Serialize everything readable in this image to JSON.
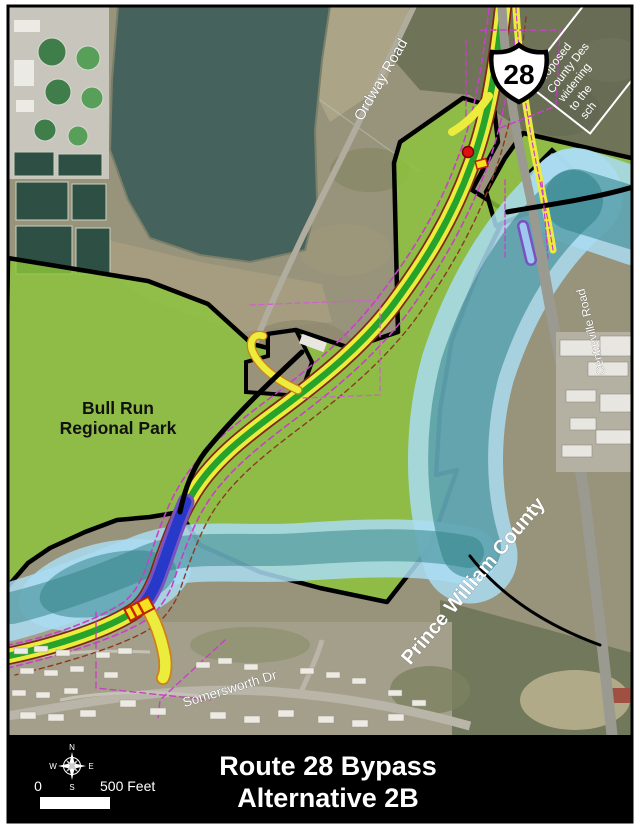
{
  "map": {
    "route_shield_number": "28",
    "park_label": {
      "line1": "Bull Run",
      "line2": "Regional Park"
    },
    "road_labels": {
      "ordway": "Ordway Road",
      "centreville": "Centreville Road",
      "somersworth": "Somersworth Dr"
    },
    "county_label": "Prince William County",
    "note_box": {
      "line1": "Proposed",
      "line2": "County Des",
      "line3": "widening",
      "line4": "to the",
      "line5": "sch"
    }
  },
  "title_bar": {
    "line1": "Route 28 Bypass",
    "line2": "Alternative 2B",
    "scale_zero": "0",
    "scale_label": "500 Feet",
    "compass": {
      "n": "N",
      "s": "S",
      "e": "E",
      "w": "W"
    }
  },
  "palette": {
    "park_green": "#8cc63c",
    "floodplain_blue": "#aadcf2",
    "water_teal": "#2e7f86",
    "bypass_yellow": "#ecec3d",
    "bypass_green": "#27a22b",
    "bypass_edge_red": "#7e2817",
    "bridge_blue": "#2739c8",
    "bridge_purple": "#7a52c0",
    "row_magenta": "#c93fc9",
    "boundary_black": "#000000",
    "titlebar_black": "#000000"
  }
}
